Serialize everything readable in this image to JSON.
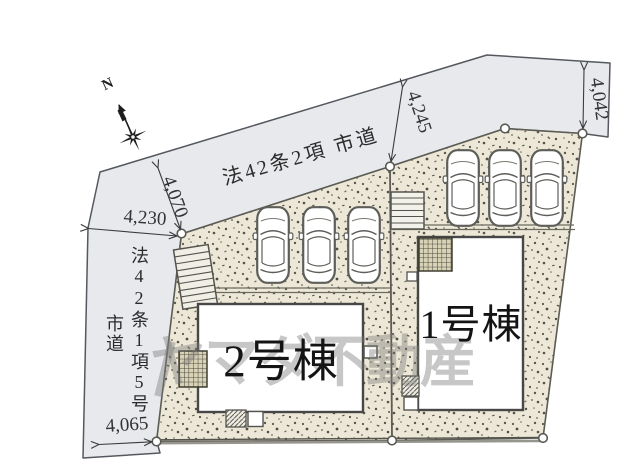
{
  "compass": {
    "north_label": "N"
  },
  "roads": {
    "top_label": "法42条2項 市道",
    "left_label_col1": "法42条1項5号",
    "left_label_col2": "市道"
  },
  "dimensions": {
    "top_left_width": "4,230",
    "top_left_depth": "4,070",
    "top_mid_depth": "4,245",
    "top_right_depth": "4,042",
    "bottom_left_width": "4,065"
  },
  "buildings": {
    "building1": "1号棟",
    "building2": "2号棟"
  },
  "watermark": "ヤマダ不動産",
  "colors": {
    "road_fill": "#e7e9ed",
    "plot_fill": "#ece7d6",
    "outline": "#55564f",
    "building_fill": "#ffffff"
  }
}
